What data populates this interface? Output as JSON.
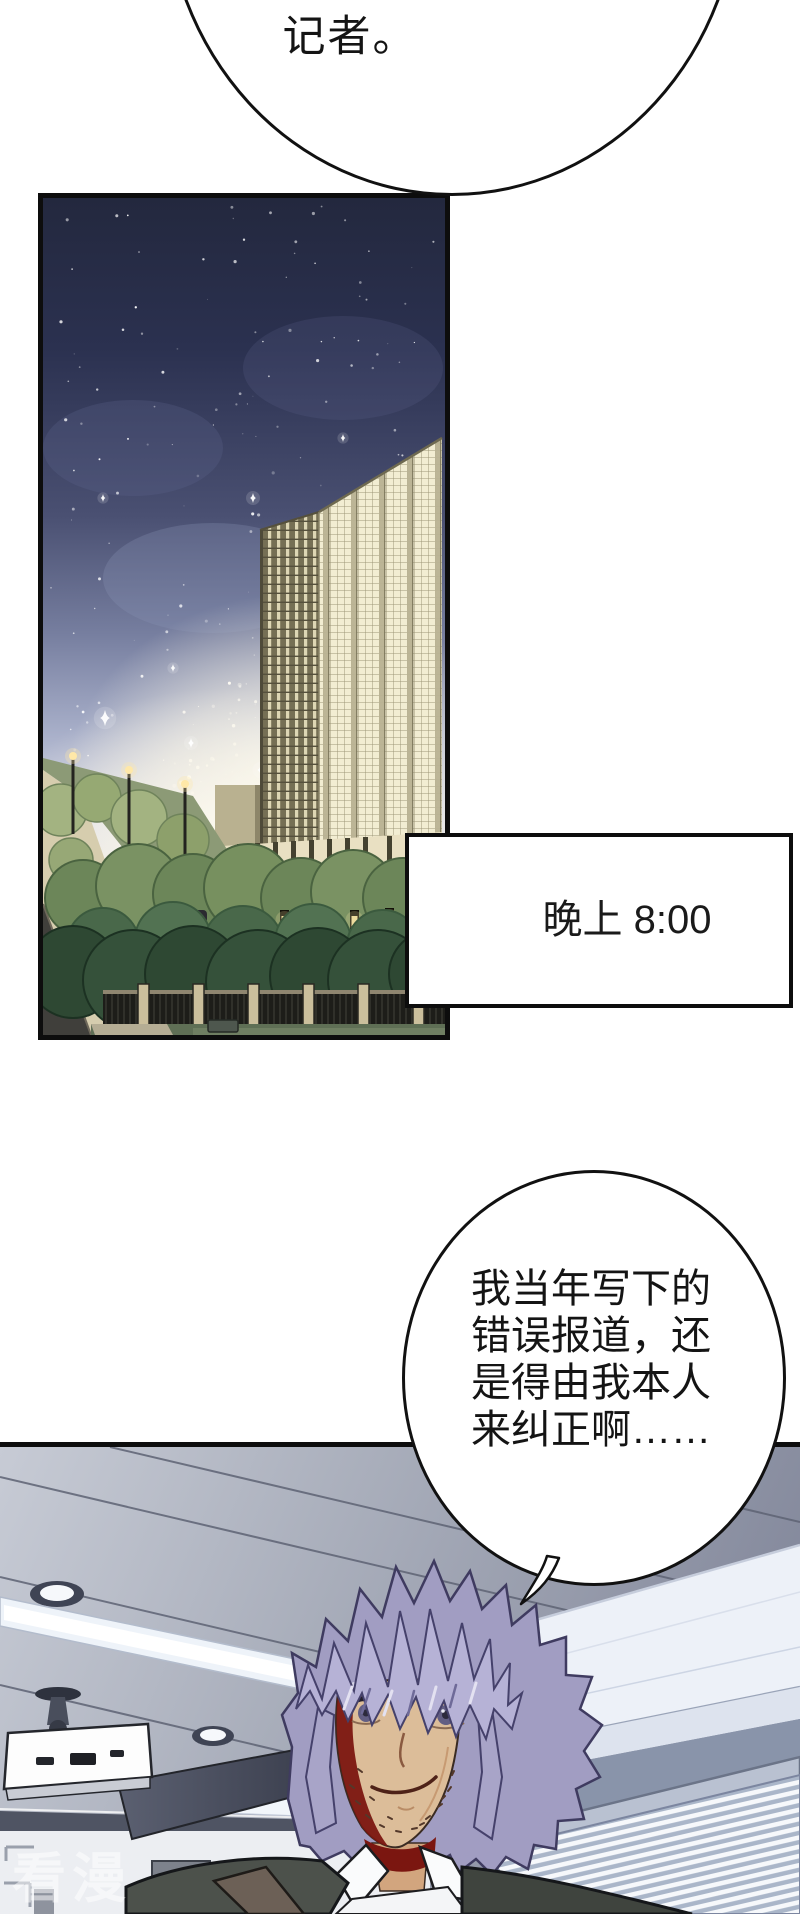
{
  "page": {
    "width": 800,
    "height": 1914,
    "background": "#ffffff"
  },
  "speech": {
    "top_bubble": {
      "text": "记者。"
    },
    "thought_bubble": {
      "lines": [
        "我当年写下的",
        "错误报道，还",
        "是得由我本人",
        "来纠正啊……"
      ]
    }
  },
  "caption_box": {
    "text": "晚上 8:00"
  },
  "watermark": {
    "text": "看漫"
  },
  "colors": {
    "ink": "#111111",
    "panel_border": "#0d0d0d",
    "bubble_bg": "#ffffff",
    "page_bg": "#ffffff",
    "sky_top": "#252a41",
    "sky_glow": "#f4f1e6",
    "building_lit": "#f2edd2",
    "building_pier": "#b9b293",
    "tree_dark": "#2e4833",
    "tree_mid": "#6c8659",
    "ceiling": "#a9aebb",
    "beam": "#edf1f8",
    "hair": "#b6b2d6",
    "skin": "#dcbd99",
    "shadow_maroon": "#7b1610",
    "vest": "#4c514b"
  }
}
